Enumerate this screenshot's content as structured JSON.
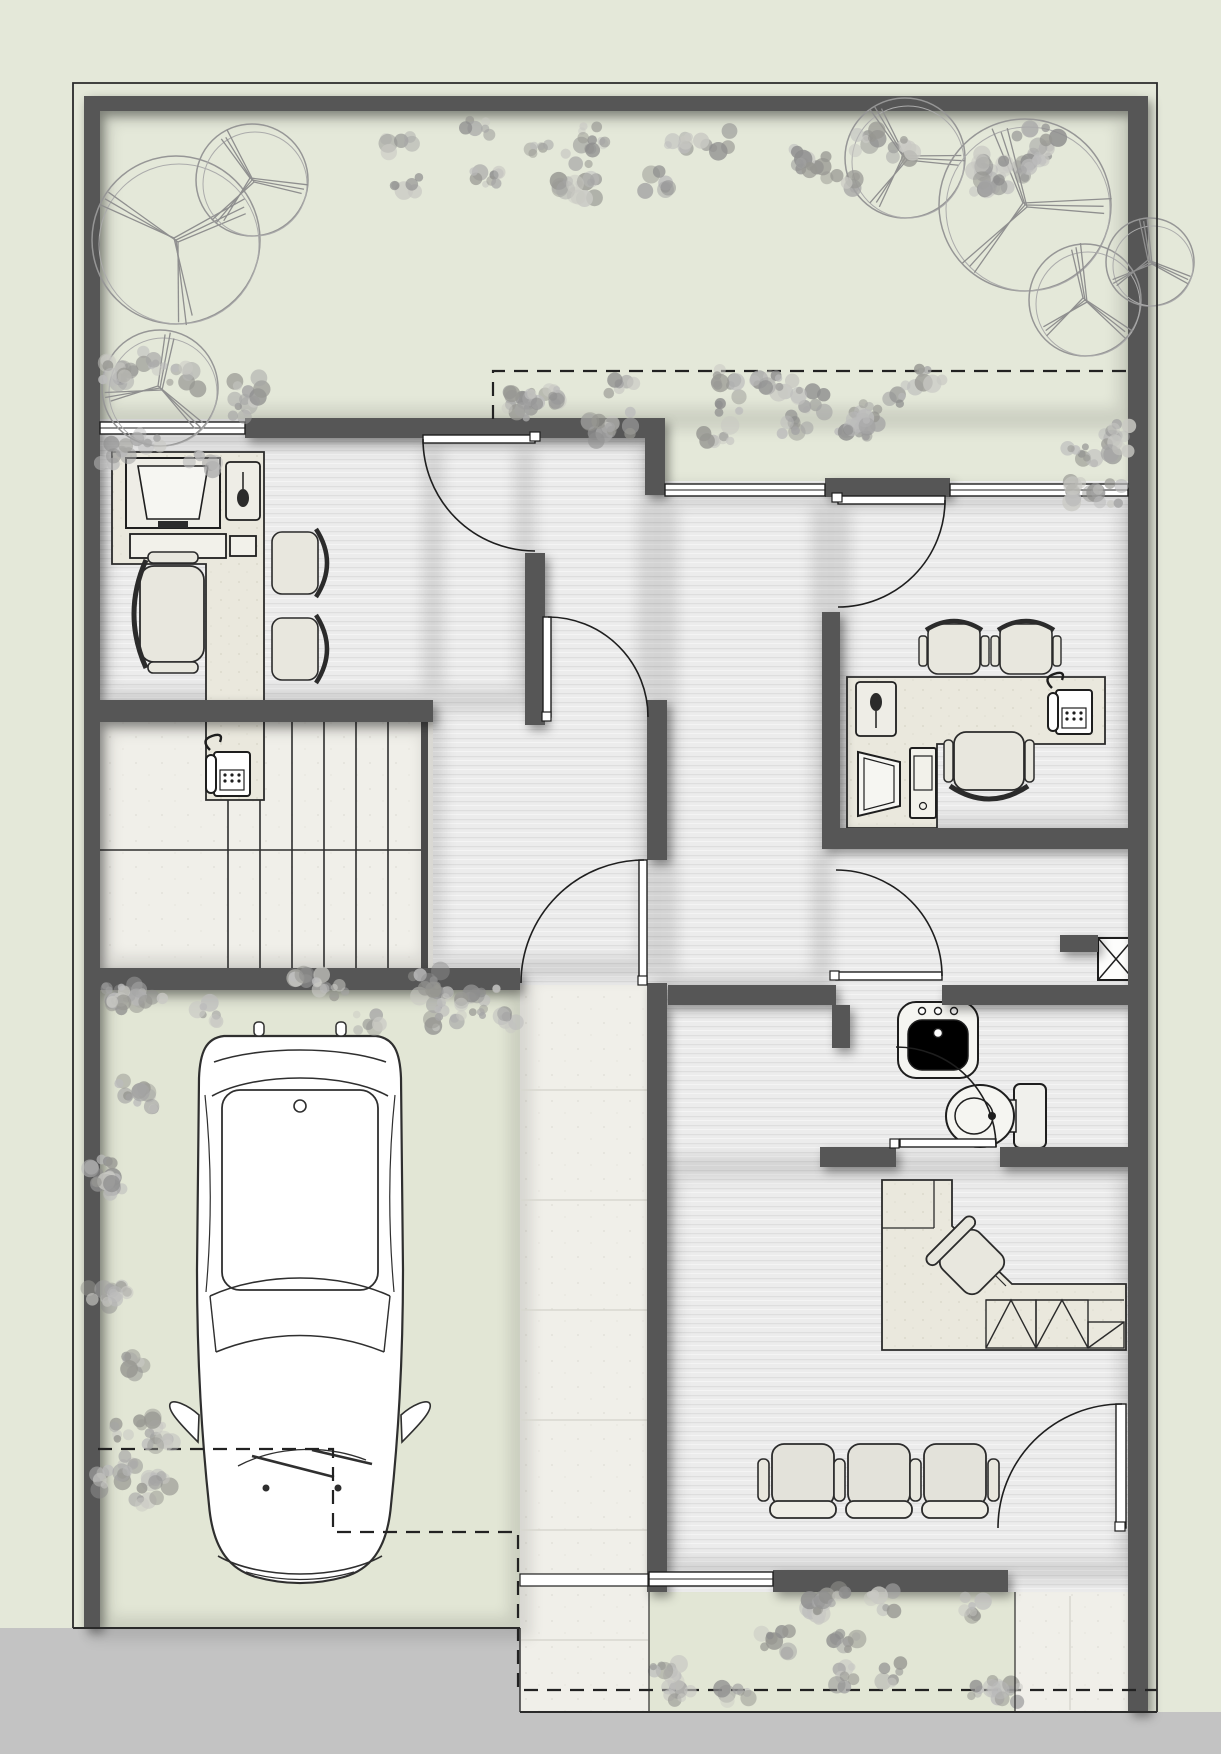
{
  "document": {
    "kind": "architectural floor plan",
    "floor": "ground floor with site garden, garage and driveway",
    "style": "grayscale presentation plan, no text labels",
    "visible_text_items": []
  },
  "palette": {
    "garden": "#e4e8d9",
    "garage_lawn": "#e2e6d5",
    "floor_stripe_base": "#ececec",
    "marble": "#f0efe9",
    "wall": "#575757",
    "apron": "#c3c3c3",
    "dashed": "#222222",
    "line": "#2a2a2a",
    "furniture_fill": "#e8e7de",
    "white": "#ffffff",
    "shrub_dark": "#8e8e8e",
    "tree_stroke": "#969696"
  },
  "inventory": {
    "site": [
      "perimeter-boundary",
      "compound-wall",
      "front-garden",
      "rear-driveway-apron",
      "entry-walkway",
      "setback-dashed-lines"
    ],
    "rooms": [
      {
        "name": "office-1",
        "furniture": [
          "l-desk",
          "monitor",
          "keyboard",
          "mouse-pad",
          "telephone",
          "executive-chair",
          "guest-chair-1",
          "guest-chair-2"
        ]
      },
      {
        "name": "entry-hall"
      },
      {
        "name": "staircase",
        "details": [
          "two-flights",
          "side-landing"
        ]
      },
      {
        "name": "garage-carport",
        "contents": [
          "car-top-view"
        ]
      },
      {
        "name": "office-2",
        "furniture": [
          "l-desk",
          "monitor",
          "cpu-tower",
          "mouse-pad",
          "telephone",
          "task-chair",
          "guest-chair-1",
          "guest-chair-2"
        ]
      },
      {
        "name": "vestibule",
        "details": [
          "service-shaft-x-box"
        ]
      },
      {
        "name": "bathroom",
        "fixtures": [
          "wash-basin",
          "toilet"
        ]
      },
      {
        "name": "waiting-room",
        "furniture": [
          "corner-counter",
          "hatched-cabinets",
          "swivel-chair-45deg",
          "waiting-chair-row-of-3"
        ]
      }
    ],
    "counts": {
      "doors": 7,
      "windows": 4,
      "waiting_chairs": 3,
      "guest_chairs": 4,
      "desks": 3,
      "trees": 7,
      "cars": 1
    }
  }
}
